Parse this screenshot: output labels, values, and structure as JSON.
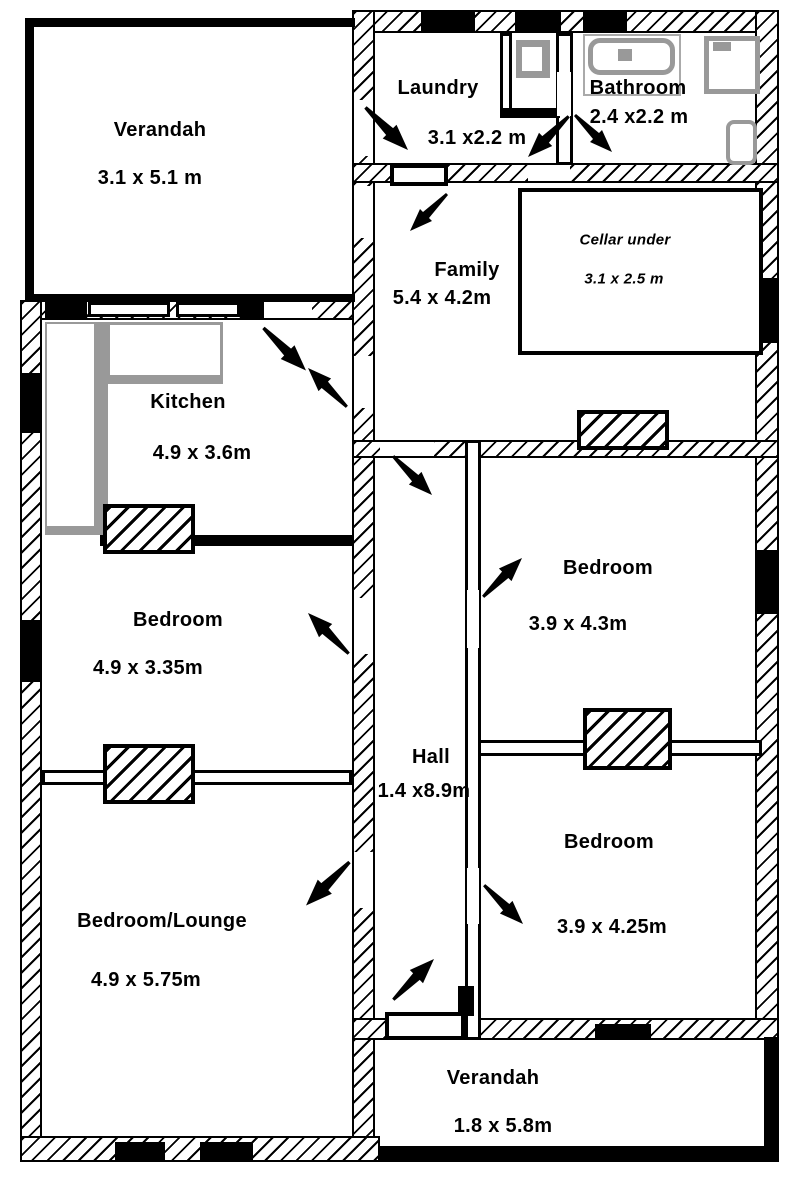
{
  "title": "House floor plan",
  "rooms": [
    {
      "id": "verandah-top",
      "name": "Verandah",
      "dims": "3.1 x 5.1 m"
    },
    {
      "id": "laundry",
      "name": "Laundry",
      "dims": "3.1 x2.2 m"
    },
    {
      "id": "bathroom",
      "name": "Bathroom",
      "dims": "2.4 x2.2 m"
    },
    {
      "id": "family",
      "name": "Family",
      "dims": "5.4 x 4.2m"
    },
    {
      "id": "cellar",
      "name": "Cellar under",
      "dims": "3.1 x 2.5 m"
    },
    {
      "id": "kitchen",
      "name": "Kitchen",
      "dims": "4.9 x 3.6m"
    },
    {
      "id": "bedroom-left",
      "name": "Bedroom",
      "dims": "4.9 x 3.35m"
    },
    {
      "id": "bedroom-right-top",
      "name": "Bedroom",
      "dims": "3.9 x 4.3m"
    },
    {
      "id": "hall",
      "name": "Hall",
      "dims": "1.4 x8.9m"
    },
    {
      "id": "bedroom-right-bottom",
      "name": "Bedroom",
      "dims": "3.9 x 4.25m"
    },
    {
      "id": "bedroom-lounge",
      "name": "Bedroom/Lounge",
      "dims": "4.9 x 5.75m"
    },
    {
      "id": "verandah-bottom",
      "name": "Verandah",
      "dims": "1.8 x 5.8m"
    }
  ],
  "colors": {
    "wall": "#000000",
    "fixture_gray": "#999999",
    "background": "#ffffff"
  },
  "icons": {
    "door-swing": "tapered-diagonal-arrow",
    "window": "solid-black-bar",
    "chimney": "hatched-bordered-box",
    "fixtures": [
      "bathtub",
      "shower",
      "toilet",
      "laundry-trough",
      "kitchen-counter"
    ]
  }
}
